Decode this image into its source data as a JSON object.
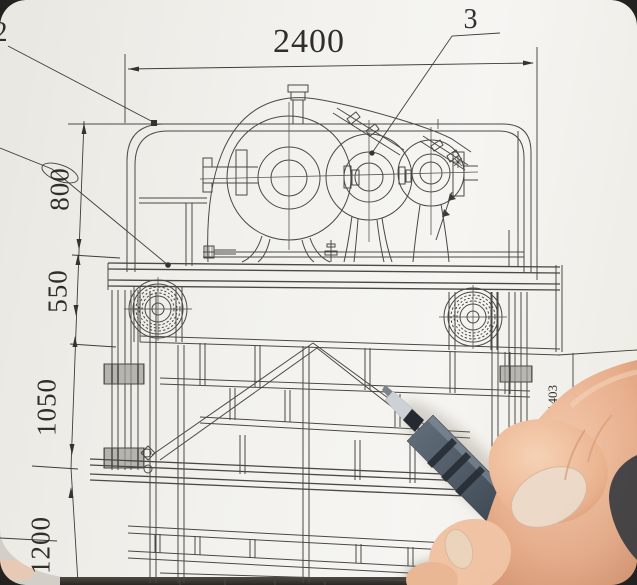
{
  "drawing": {
    "dim_top": "2400",
    "dim_left": [
      "800",
      "550",
      "1050",
      "1200"
    ],
    "dim_right": "1403",
    "callout_top": "3",
    "callout_corner": "2"
  },
  "colors": {
    "paper": "#f2f1ed",
    "ink": "#3c3b37",
    "pen_barrel": "#4b5663",
    "skin": "#eab795",
    "table": "#2e2c28"
  }
}
